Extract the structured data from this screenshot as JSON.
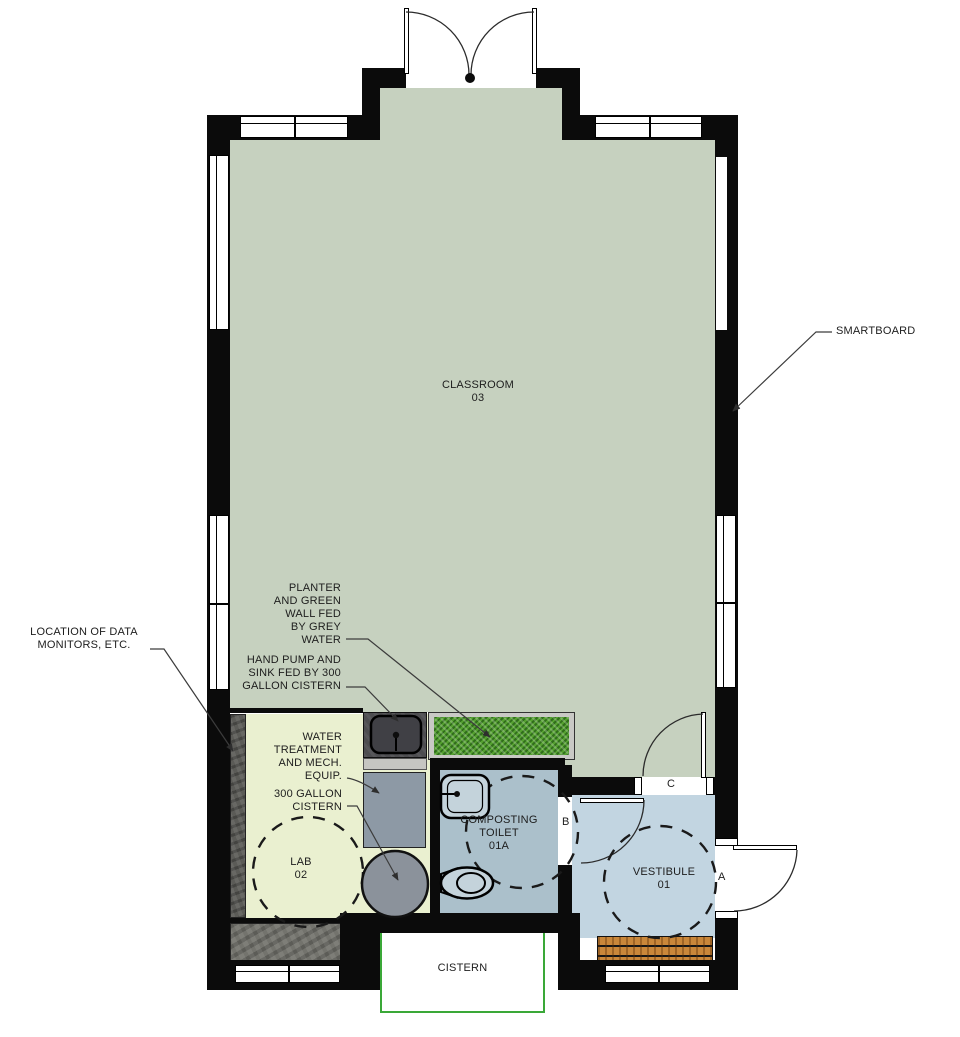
{
  "drawing": {
    "rooms": {
      "classroom": {
        "name": "CLASSROOM",
        "number": "03"
      },
      "lab": {
        "name": "LAB",
        "number": "02"
      },
      "toilet": {
        "line1": "COMPOSTING",
        "line2": "TOILET",
        "number": "01A"
      },
      "vestibule": {
        "name": "VESTIBULE",
        "number": "01"
      }
    },
    "labels": {
      "smartboard": "SMARTBOARD",
      "cistern": "CISTERN",
      "data_monitors": {
        "line1": "LOCATION OF DATA",
        "line2": "MONITORS, ETC."
      },
      "planter": {
        "line1": "PLANTER",
        "line2": "AND GREEN",
        "line3": "WALL FED",
        "line4": "BY GREY",
        "line5": "WATER"
      },
      "hand_pump": {
        "line1": "HAND PUMP AND",
        "line2": "SINK FED BY 300",
        "line3": "GALLON CISTERN"
      },
      "water_treatment": {
        "line1": "WATER",
        "line2": "TREATMENT",
        "line3": "AND MECH.",
        "line4": "EQUIP."
      },
      "gallon_cistern": {
        "line1": "300 GALLON",
        "line2": "CISTERN"
      }
    },
    "door_tags": {
      "a": "A",
      "b": "B",
      "c": "C"
    },
    "colors": {
      "wall": "#0b0b0b",
      "classroom_floor": "#c6d1bf",
      "lab_floor": "#eaf0d0",
      "toilet_floor": "#abc0cb",
      "vestibule_floor": "#c2d5e1",
      "planter_grass": "#55a130",
      "wood_deck": "#c9873a",
      "cistern_outline": "#3aa838",
      "equipment_gray": "#8d99a5"
    }
  }
}
